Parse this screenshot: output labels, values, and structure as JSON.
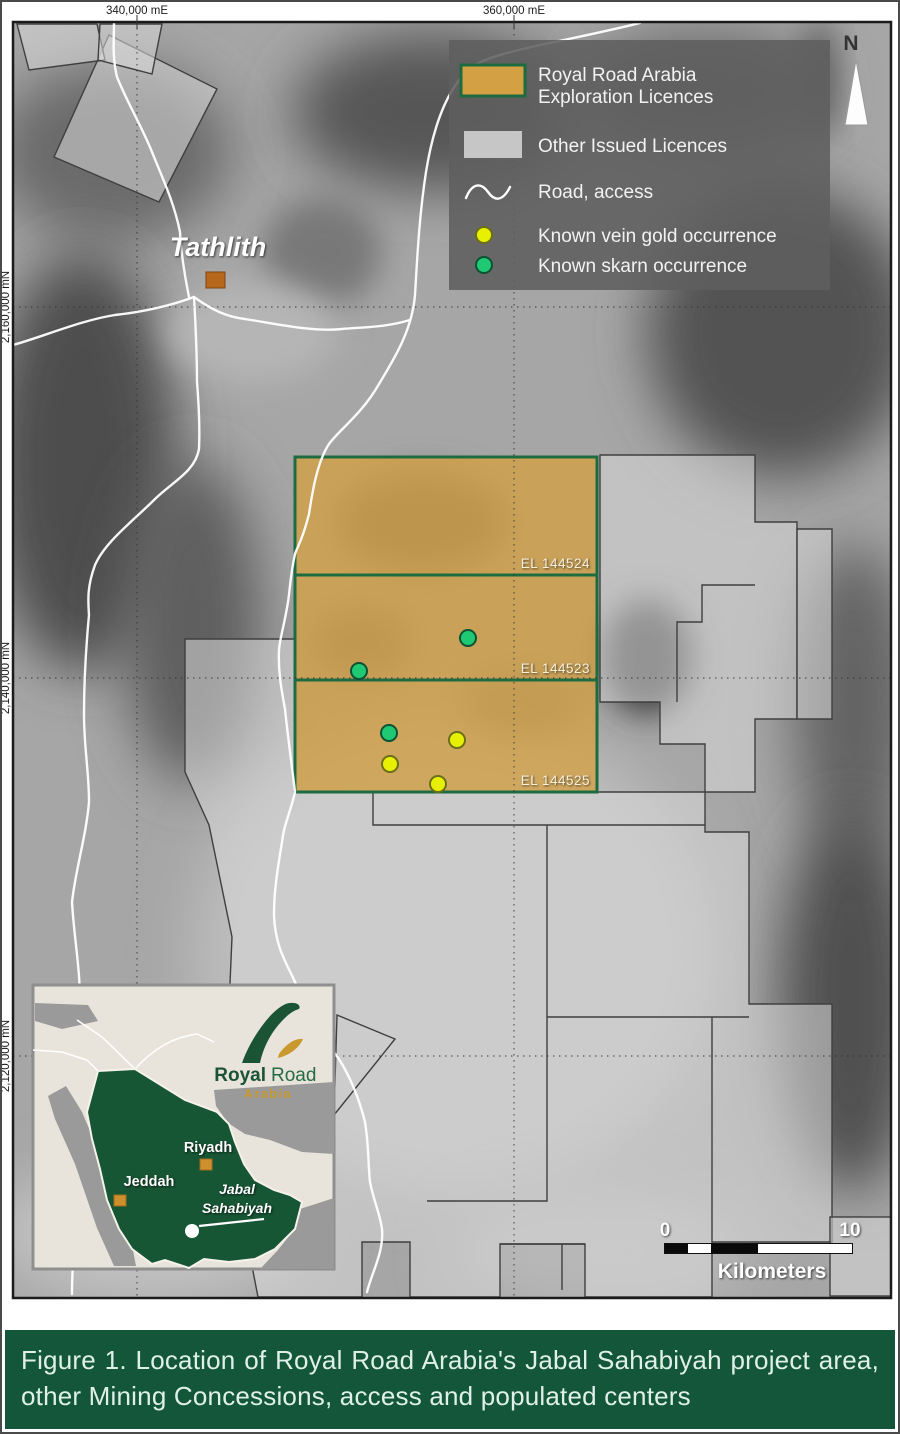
{
  "figure": {
    "caption": "Figure 1. Location of Royal Road Arabia's Jabal Sahabiyah project area, other Mining Concessions, access and populated centers"
  },
  "map": {
    "axis": {
      "top": [
        "340,000 mE",
        "360,000 mE"
      ],
      "left": [
        "2,160,000 mN",
        "2,140,000 mN",
        "2,120,000 mN"
      ]
    },
    "north_label": "N",
    "town_label": "Tathlith",
    "licence_labels": [
      "EL 144524",
      "EL 144523",
      "EL 144525"
    ],
    "legend": {
      "exploration_line1": "Royal Road Arabia",
      "exploration_line2": "Exploration Licences",
      "other_licences": "Other Issued Licences",
      "road": "Road, access",
      "gold": "Known vein gold occurrence",
      "skarn": "Known skarn occurrence"
    },
    "scalebar": {
      "start": "0",
      "end": "10",
      "unit": "Kilometers"
    },
    "occurrences": {
      "gold": [
        {
          "x": 455,
          "y": 738
        },
        {
          "x": 388,
          "y": 762
        },
        {
          "x": 436,
          "y": 782
        }
      ],
      "skarn": [
        {
          "x": 466,
          "y": 636
        },
        {
          "x": 357,
          "y": 669
        },
        {
          "x": 387,
          "y": 731
        }
      ]
    },
    "colors": {
      "exploration_fill": "#D4A044",
      "exploration_border": "#1D6B40",
      "other_licence_fill": "#D8D8D8",
      "gold_dot": "#E7F000",
      "skarn_dot": "#1FC873",
      "road": "#FFFFFF",
      "caption_bg": "#14563A",
      "logo_green": "#1B5434",
      "logo_gold": "#C9992E",
      "town_marker": "#B5671B"
    }
  },
  "inset": {
    "logo": {
      "brand_bold": "Royal",
      "brand_light": "Road",
      "region": "Arabia"
    },
    "cities": [
      "Riyadh",
      "Jeddah"
    ],
    "project_line1": "Jabal",
    "project_line2": "Sahabiyah"
  }
}
